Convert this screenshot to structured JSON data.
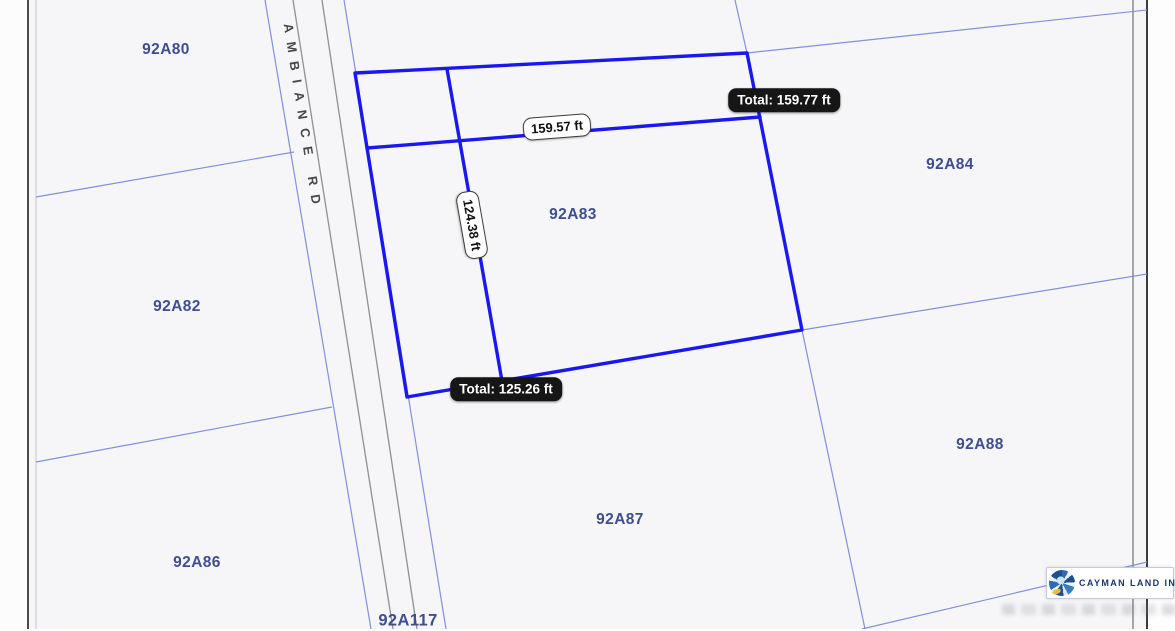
{
  "map": {
    "road": {
      "name": "AMBIANCE RD"
    },
    "parcels": [
      {
        "id": "92A80"
      },
      {
        "id": "92A82"
      },
      {
        "id": "92A83"
      },
      {
        "id": "92A84"
      },
      {
        "id": "92A86"
      },
      {
        "id": "92A87"
      },
      {
        "id": "92A88"
      },
      {
        "id": "92A117"
      }
    ],
    "highlighted_parcel": "92A83",
    "measurements": {
      "segment_a": "159.57 ft",
      "segment_a_total": "Total: 159.77 ft",
      "segment_b": "124.38 ft",
      "segment_b_total": "Total: 125.26 ft"
    },
    "colors": {
      "highlight_line": "#1a18ee",
      "boundary_line": "#8191d8",
      "road_edge_line": "#909090",
      "parcel_label": "#3f4e8e",
      "background": "#f6f6f8"
    }
  },
  "watermark": {
    "logo_text": "CAYMAN LAND INFO"
  }
}
